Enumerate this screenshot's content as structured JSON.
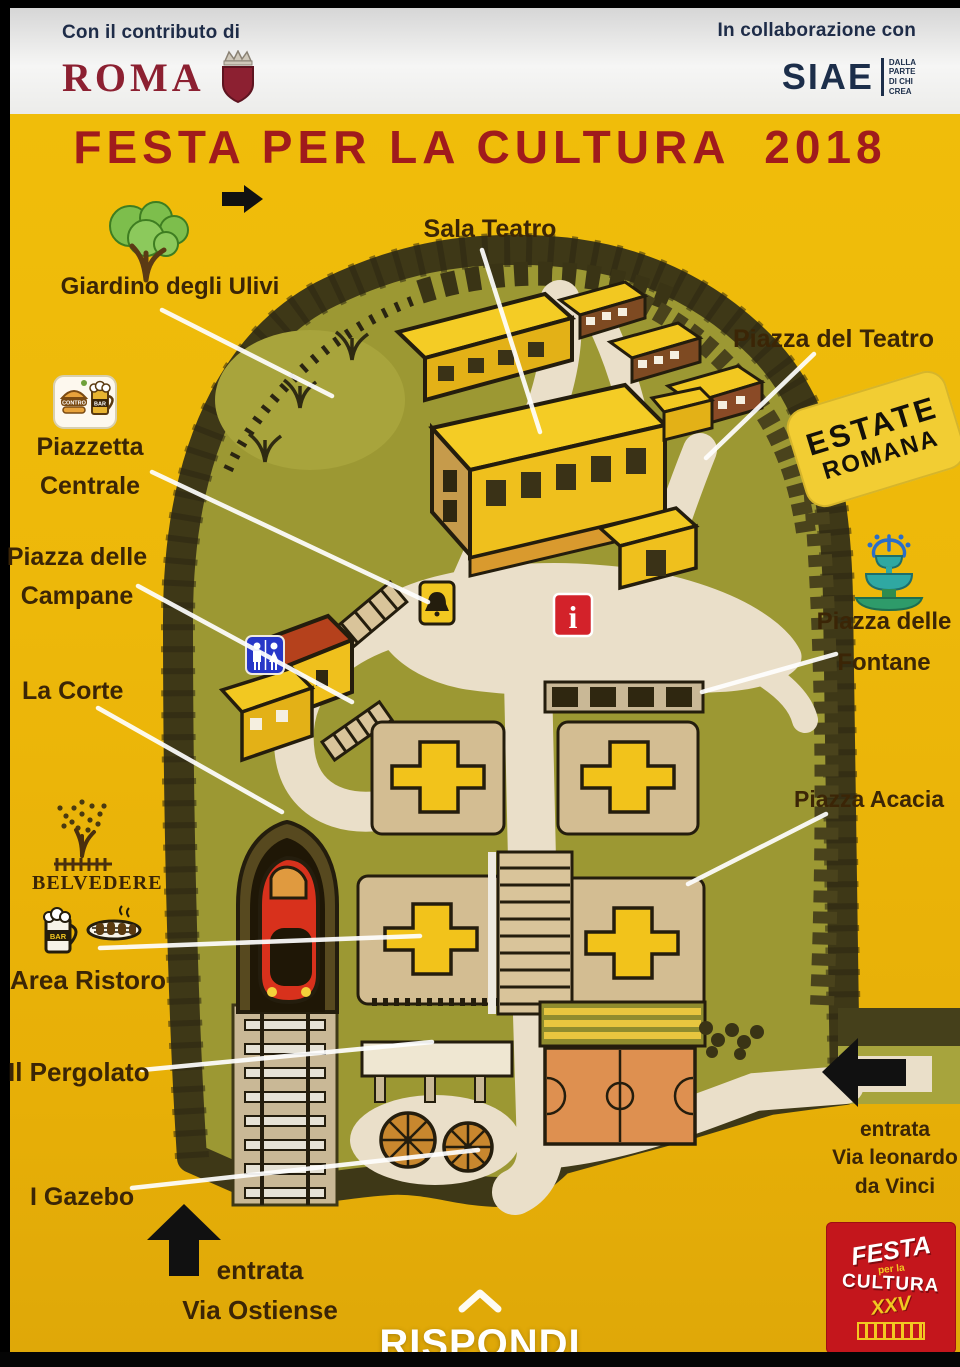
{
  "header": {
    "left": {
      "pretext": "Con il contributo di",
      "logo_text": "ROMA"
    },
    "right": {
      "pretext": "In collaborazione con",
      "logo_text": "SIAE",
      "tagline": "DALLA\nPARTE\nDI CHI\nCREA"
    }
  },
  "title": "FESTA PER LA CULTURA  2018",
  "badge": {
    "line1": "ESTATE",
    "line2": "ROMANA"
  },
  "map": {
    "labels": {
      "sala_teatro": "Sala Teatro",
      "giardino_ulivi": "Giardino degli Ulivi",
      "piazza_del_teatro": "Piazza del Teatro",
      "piazzetta_centrale": "Piazzetta\nCentrale",
      "piazza_delle_campane": "Piazza delle\nCampane",
      "la_corte": "La Corte",
      "piazza_delle_fontane": "Piazza delle\nFontane",
      "piazza_acacia": "Piazza Acacia",
      "belvedere": "BELVEDERE",
      "area_ristoro": "Area Ristoro",
      "il_pergolato": "Il Pergolato",
      "i_gazebo": "I Gazebo",
      "entrata_ostiense": "entrata\nVia Ostiense",
      "entrata_da_vinci": "entrata\nVia leonardo\nda Vinci"
    },
    "icons": {
      "controbar_text_top": "CONTRO",
      "controbar_text_bar": "BAR",
      "bar_mug_text": "BAR",
      "info_glyph": "i"
    }
  },
  "footer": {
    "reply_label": "RISPONDI"
  },
  "festa_logo": {
    "line1": "FESTA",
    "line2": "per la",
    "line3": "CULTURA",
    "line4": "XXV"
  },
  "colors": {
    "background_yellow": "#EDB80A",
    "title_red": "#A01B1C",
    "navy": "#1C2E4A",
    "roma_red": "#8C2031",
    "label_brown": "#3B2506",
    "map_green": "#9C9833",
    "path_cream": "#EADFC9",
    "building_yellow": "#F2C821",
    "train_red": "#D8311C",
    "court_orange": "#DE9050",
    "wc_blue": "#2737C8",
    "info_red": "#D3222A",
    "fountain_teal": "#2FA8A2",
    "badge_yellow": "#F2CD33",
    "logo_red": "#C4161C"
  }
}
